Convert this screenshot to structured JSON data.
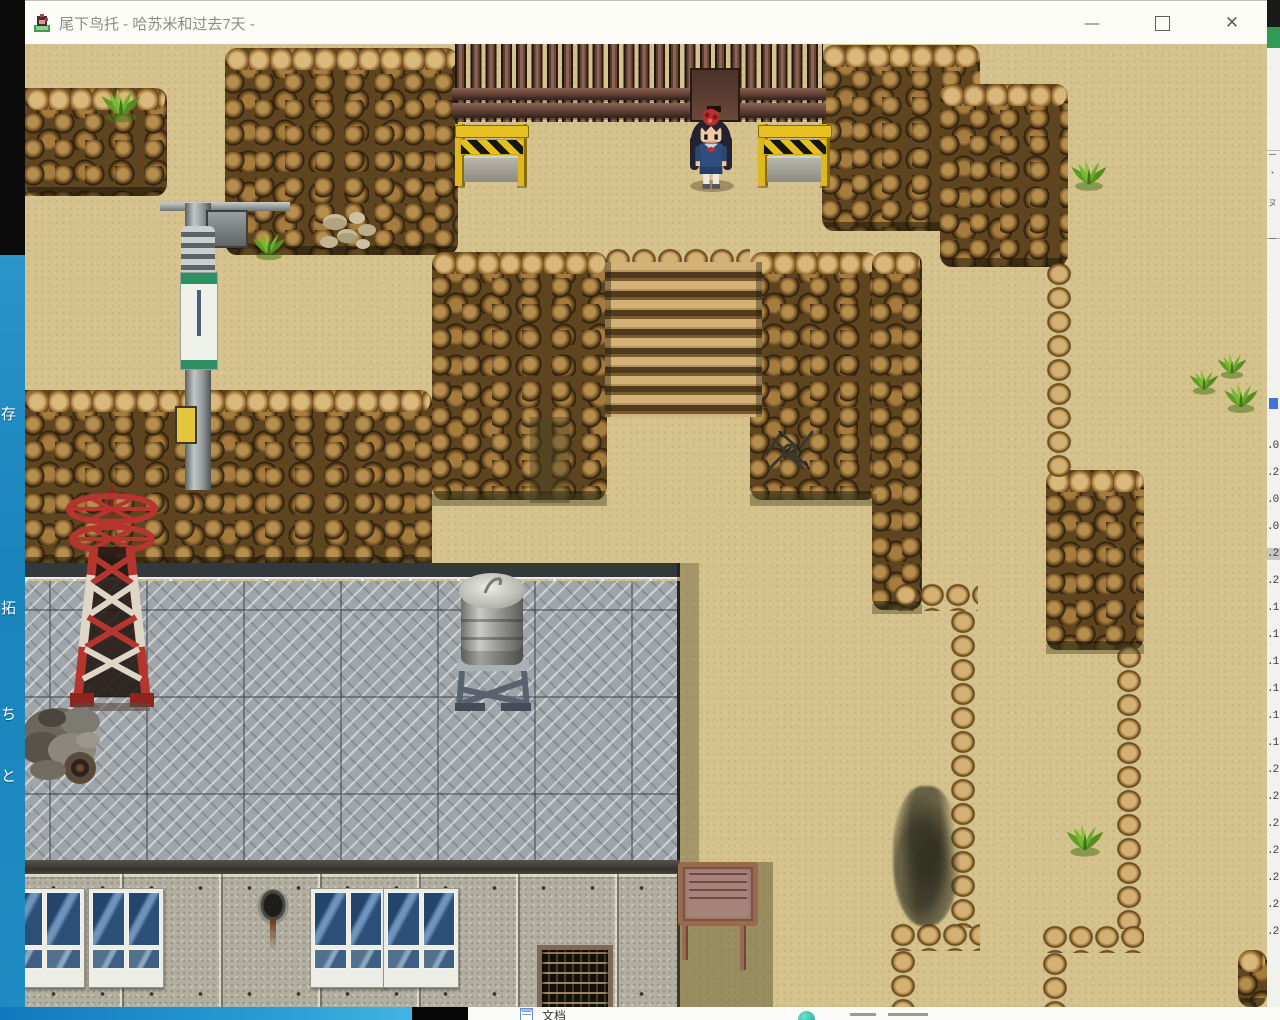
{
  "window": {
    "title": "尾下鸟托 - 哈苏米和过去7天 -",
    "minimize_glyph": "—",
    "maximize_glyph": "□",
    "close_glyph": "✕"
  },
  "left_edge": {
    "fragments": [
      {
        "text": "存",
        "top": 406
      },
      {
        "text": "拓",
        "top": 600
      },
      {
        "text": "ち",
        "top": 706
      },
      {
        "text": "と",
        "top": 768
      }
    ]
  },
  "right_edge": {
    "marks": [
      {
        "text": "ー",
        "top": 148
      },
      {
        "text": "・",
        "top": 166
      },
      {
        "text": "ヌ",
        "top": 196
      },
      {
        "text": "ー",
        "top": 232
      }
    ],
    "numbers": [
      ".0",
      ".2",
      ".0",
      ".0",
      ".2",
      ".2",
      ".1",
      ".1",
      ".1",
      ".1",
      ".1",
      ".1",
      ".2",
      ".2",
      ".2",
      ".2",
      ".2",
      ".2",
      ".2"
    ],
    "numbers_top": 440,
    "numbers_step": 27,
    "highlight_index": 4
  },
  "taskbar": {
    "doc_label": "文档"
  },
  "colors": {
    "sand": "#d5c28c",
    "cliff_brown": "#6e5226",
    "accent_blue": "#1c8ac0",
    "barrier_yellow": "#e5c020",
    "tower_red": "#b5352f",
    "roof_gray": "#9fa5a8",
    "teal_badge": "#27b9a5",
    "uniform_navy": "#2e4e7e"
  }
}
